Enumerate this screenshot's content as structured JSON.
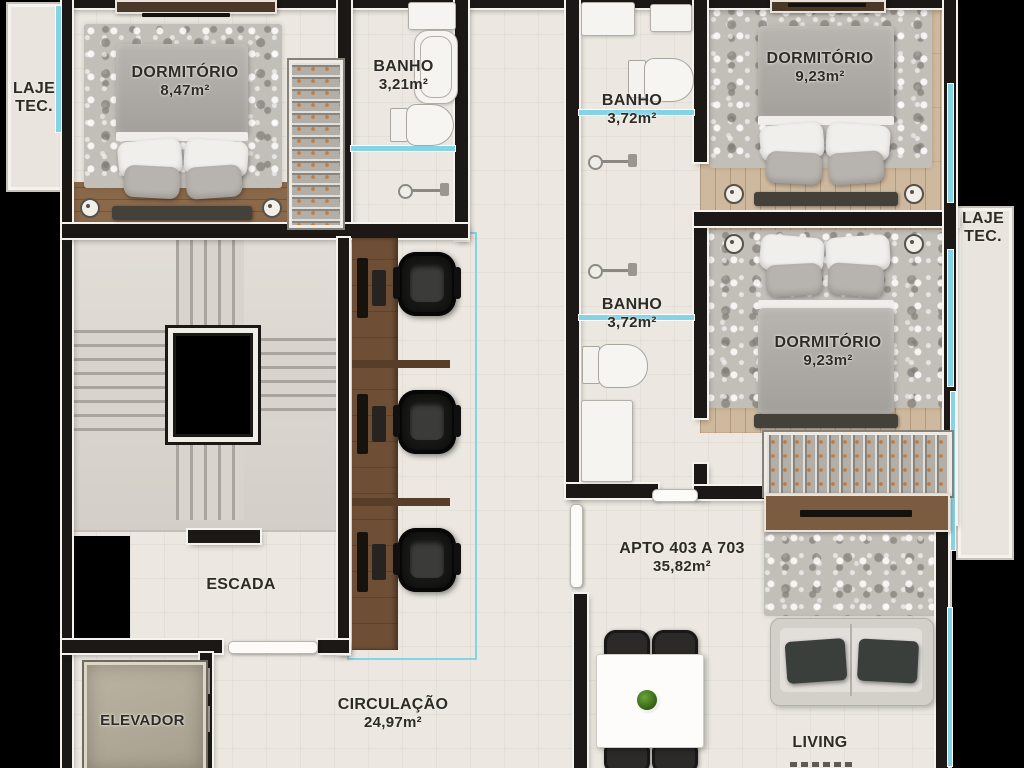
{
  "plan": {
    "laje_left": {
      "line1": "LAJE",
      "line2": "TEC."
    },
    "laje_right": {
      "line1": "LAJE",
      "line2": "TEC."
    },
    "dormitorio_top_left": {
      "name": "DORMITÓRIO",
      "area": "8,47m²"
    },
    "banho_top_left": {
      "name": "BANHO",
      "area": "3,21m²"
    },
    "banho_top_right": {
      "name": "BANHO",
      "area": "3,72m²"
    },
    "dormitorio_top_right": {
      "name": "DORMITÓRIO",
      "area": "9,23m²"
    },
    "banho_mid_right": {
      "name": "BANHO",
      "area": "3,72m²"
    },
    "dormitorio_mid_right": {
      "name": "DORMITÓRIO",
      "area": "9,23m²"
    },
    "escada": {
      "name": "ESCADA"
    },
    "elevador": {
      "name": "ELEVADOR"
    },
    "circulacao": {
      "name": "CIRCULAÇÃO",
      "area": "24,97m²"
    },
    "apartment": {
      "name": "APTO 403 A 703",
      "area": "35,82m²"
    },
    "living": {
      "name": "LIVING"
    }
  },
  "colors": {
    "wall": "#1b1815",
    "floor": "#ece8e1",
    "window_accent": "#84d4e6",
    "wood_floor": "#cfb99e",
    "desk_wood": "#6e4e35",
    "label_text": "#2e2b27",
    "background": "#000000"
  }
}
